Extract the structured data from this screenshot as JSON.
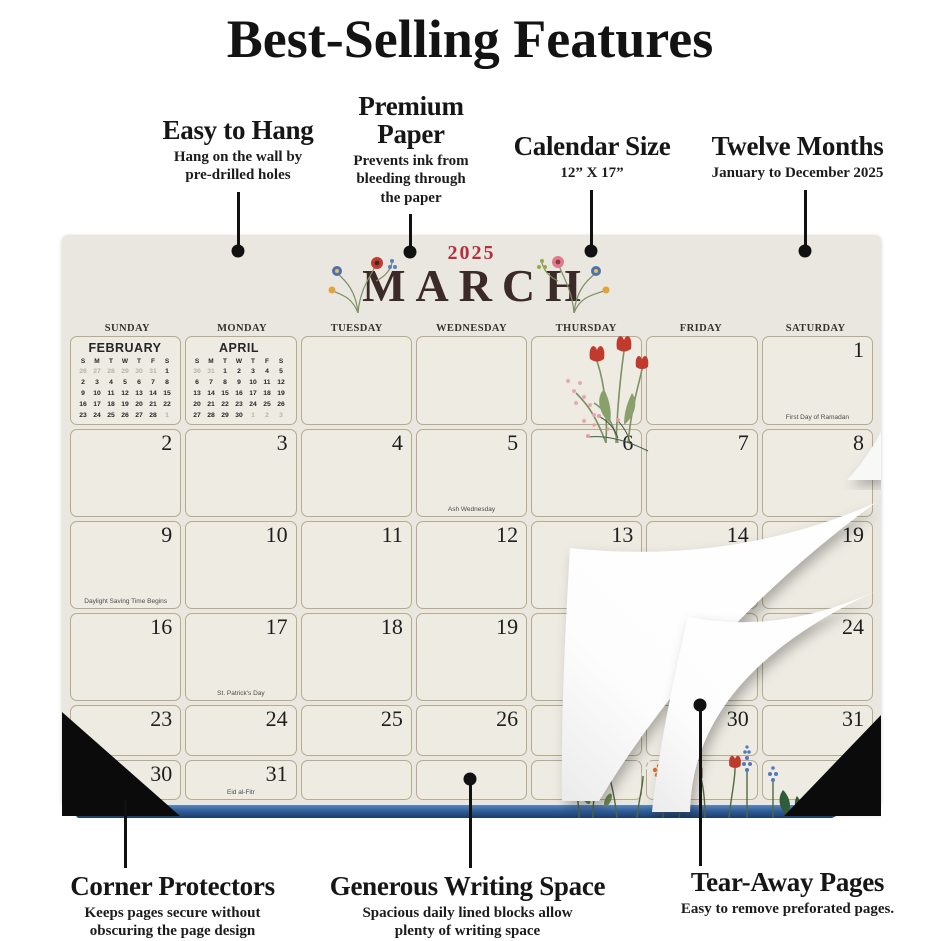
{
  "title": "Best-Selling Features",
  "callouts": {
    "easy_to_hang": {
      "heading": "Easy to Hang",
      "sub": "Hang on the wall by\npre-drilled holes"
    },
    "premium_paper": {
      "heading": "Premium\nPaper",
      "sub": "Prevents ink from\nbleeding through\nthe paper"
    },
    "calendar_size": {
      "heading": "Calendar Size",
      "sub": "12” X 17”"
    },
    "twelve_months": {
      "heading": "Twelve Months",
      "sub": "January to December 2025"
    },
    "corner_protectors": {
      "heading": "Corner Protectors",
      "sub": "Keeps pages secure without\nobscuring the page design"
    },
    "generous_writing_space": {
      "heading": "Generous Writing Space",
      "sub": "Spacious daily lined blocks allow\nplenty of writing space"
    },
    "tear_away_pages": {
      "heading": "Tear-Away Pages",
      "sub": "Easy to remove preforated pages."
    }
  },
  "calendar": {
    "year": "2025",
    "month": "MARCH",
    "day_headers": [
      "SUNDAY",
      "MONDAY",
      "TUESDAY",
      "WEDNESDAY",
      "THURSDAY",
      "FRIDAY",
      "SATURDAY"
    ],
    "weeks": [
      [
        null,
        null,
        null,
        null,
        null,
        null,
        {
          "n": "1",
          "note": "First Day of Ramadan"
        }
      ],
      [
        {
          "n": "2"
        },
        {
          "n": "3"
        },
        {
          "n": "4"
        },
        {
          "n": "5",
          "note": "Ash Wednesday"
        },
        {
          "n": "6"
        },
        {
          "n": "7"
        },
        {
          "n": "8"
        }
      ],
      [
        {
          "n": "9",
          "note": "Daylight Saving Time Begins"
        },
        {
          "n": "10"
        },
        {
          "n": "11"
        },
        {
          "n": "12"
        },
        {
          "n": "13"
        },
        {
          "n": "14"
        },
        {
          "n": "19"
        }
      ],
      [
        {
          "n": "16"
        },
        {
          "n": "17",
          "note": "St. Patrick's Day"
        },
        {
          "n": "18"
        },
        {
          "n": "19"
        },
        {
          "n": "20",
          "note": "Spring Begins"
        },
        null,
        {
          "n": "24"
        }
      ],
      [
        {
          "n": "23"
        },
        {
          "n": "24"
        },
        {
          "n": "25"
        },
        {
          "n": "26"
        },
        null,
        {
          "n": "30"
        },
        {
          "n": "31"
        }
      ],
      [
        {
          "n": "30"
        },
        {
          "n": "31",
          "note": "Eid al-Fitr"
        },
        null,
        null,
        null,
        null,
        null
      ]
    ],
    "mini_february": {
      "title": "FEBRUARY",
      "dow": [
        "S",
        "M",
        "T",
        "W",
        "T",
        "F",
        "S"
      ],
      "weeks": [
        [
          "*26",
          "*27",
          "*28",
          "*29",
          "*30",
          "*31",
          "1"
        ],
        [
          "2",
          "3",
          "4",
          "5",
          "6",
          "7",
          "8"
        ],
        [
          "9",
          "10",
          "11",
          "12",
          "13",
          "14",
          "15"
        ],
        [
          "16",
          "17",
          "18",
          "19",
          "20",
          "21",
          "22"
        ],
        [
          "23",
          "24",
          "25",
          "26",
          "27",
          "28",
          "*1"
        ]
      ]
    },
    "mini_april": {
      "title": "APRIL",
      "dow": [
        "S",
        "M",
        "T",
        "W",
        "T",
        "F",
        "S"
      ],
      "weeks": [
        [
          "*30",
          "*31",
          "1",
          "2",
          "3",
          "4",
          "5"
        ],
        [
          "6",
          "7",
          "8",
          "9",
          "10",
          "11",
          "12"
        ],
        [
          "13",
          "14",
          "15",
          "16",
          "17",
          "18",
          "19"
        ],
        [
          "20",
          "21",
          "22",
          "23",
          "24",
          "25",
          "26"
        ],
        [
          "27",
          "28",
          "29",
          "30",
          "*1",
          "*2",
          "*3"
        ]
      ]
    }
  },
  "colors": {
    "accent_red": "#b5303c",
    "month_brown": "#3c2a28",
    "pad_bg": "#e9e7e0",
    "cell_bg": "#eeebe3",
    "cell_border": "#b6ab8c",
    "strip_blue": "#2f5f9c",
    "corner_black": "#0b0b0b"
  }
}
